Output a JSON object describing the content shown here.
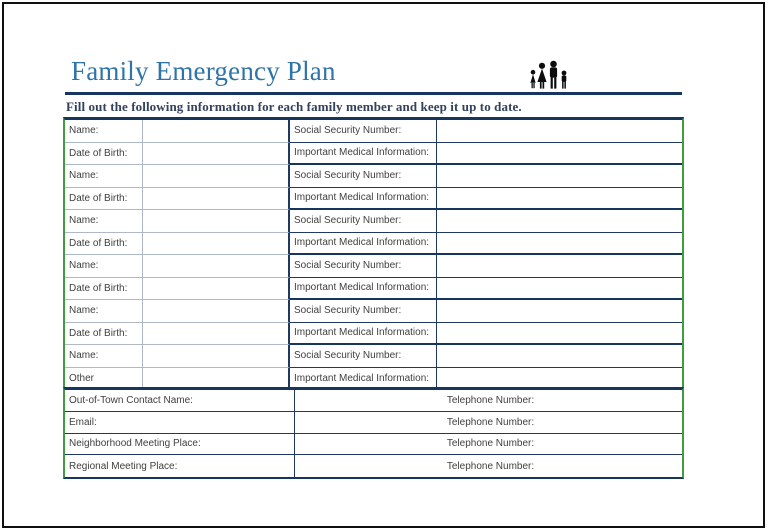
{
  "page": {
    "title": "Family Emergency Plan",
    "subtitle": "Fill out the following information for each family member and keep it up to date.",
    "icon": "family-silhouette-icon"
  },
  "colors": {
    "title_blue": "#2E74A8",
    "rule_navy": "#17365D",
    "table_navy": "#1F3864",
    "light_gray_line": "#AFB8C6",
    "outer_green": "#3F9C3F",
    "label_text": "#3F3F3F",
    "icon_black": "#0D0D0D"
  },
  "member_table": {
    "rows": [
      {
        "left": "Name:",
        "right": "Social Security Number:"
      },
      {
        "left": "Date of Birth:",
        "right": "Important Medical Information:"
      },
      {
        "left": "Name:",
        "right": "Social Security Number:"
      },
      {
        "left": "Date of Birth:",
        "right": "Important Medical Information:"
      },
      {
        "left": "Name:",
        "right": "Social Security Number:"
      },
      {
        "left": "Date of Birth:",
        "right": "Important Medical Information:"
      },
      {
        "left": "Name:",
        "right": "Social Security Number:"
      },
      {
        "left": "Date of Birth:",
        "right": "Important Medical Information:"
      },
      {
        "left": "Name:",
        "right": "Social Security Number:"
      },
      {
        "left": "Date of Birth:",
        "right": "Important Medical Information:"
      },
      {
        "left": "Name:",
        "right": "Social Security Number:"
      },
      {
        "left": "Other",
        "right": "Important Medical Information:"
      }
    ]
  },
  "contact_table": {
    "rows": [
      {
        "label": "Out-of-Town Contact Name:",
        "phone": "Telephone Number:"
      },
      {
        "label": "Email:",
        "phone": "Telephone Number:"
      },
      {
        "label": "Neighborhood Meeting Place:",
        "phone": "Telephone Number:"
      },
      {
        "label": "Regional Meeting Place:",
        "phone": "Telephone Number:"
      }
    ]
  }
}
